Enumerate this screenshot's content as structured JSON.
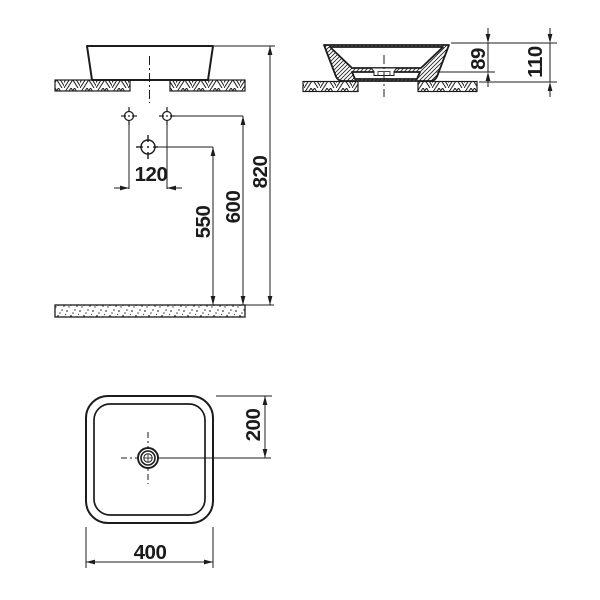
{
  "drawing": {
    "front_view": {
      "tap_hole_spacing": "120",
      "drain_outlet_height": "550",
      "tap_hole_height": "600",
      "rim_height": "820"
    },
    "side_view": {
      "bowl_depth": "89",
      "overall_height": "110"
    },
    "plan_view": {
      "drain_offset": "200",
      "overall_width": "400"
    }
  }
}
